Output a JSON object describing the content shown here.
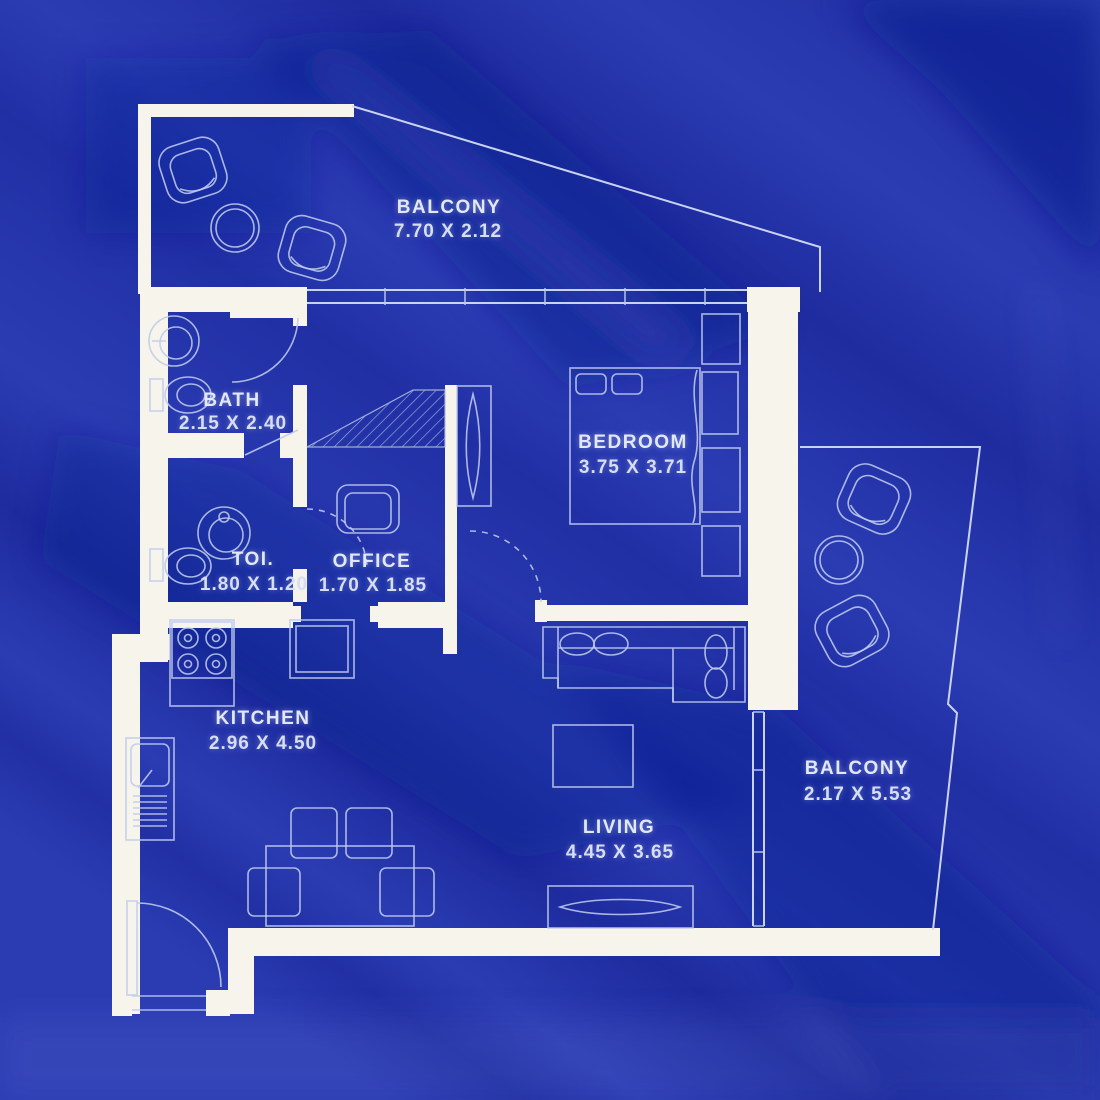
{
  "image_type": "apartment-floor-plan-blueprint",
  "colors": {
    "background": "#2b3cb3",
    "fold_shadow": "#0e1d8e",
    "wall": "#f7f4ec",
    "drawing_line": "#c3cfef",
    "label_text": "#e2e8f8"
  },
  "rooms": {
    "balcony_top": {
      "label": "BALCONY",
      "dims": "7.70 X 2.12"
    },
    "bath": {
      "label": "BATH",
      "dims": "2.15 X 2.40"
    },
    "bedroom": {
      "label": "BEDROOM",
      "dims": "3.75 X 3.71"
    },
    "toilet": {
      "label": "TOI.",
      "dims": "1.80 X 1.20"
    },
    "office": {
      "label": "OFFICE",
      "dims": "1.70 X 1.85"
    },
    "kitchen": {
      "label": "KITCHEN",
      "dims": "2.96 X 4.50"
    },
    "living": {
      "label": "LIVING",
      "dims": "4.45 X 3.65"
    },
    "balcony_right": {
      "label": "BALCONY",
      "dims": "2.17 X 5.53"
    }
  }
}
